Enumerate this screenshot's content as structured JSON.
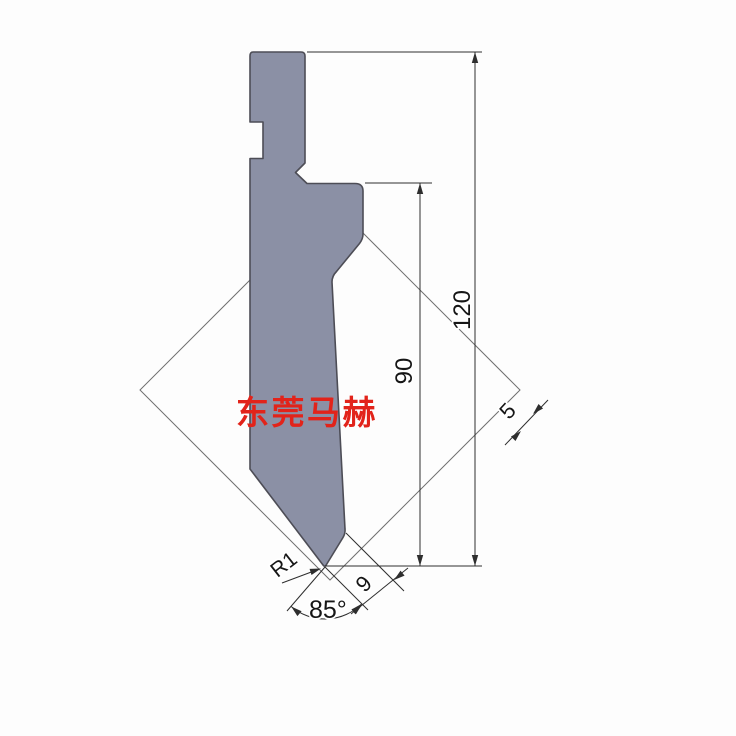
{
  "labels": {
    "overall_height": "120",
    "blade_height": "90",
    "grid_pitch": "5",
    "tip_width": "9",
    "tip_radius": "R1",
    "tip_angle": "85°"
  },
  "watermark": {
    "text": "东莞马赫",
    "color": "#e2231a"
  },
  "colors": {
    "punch_fill": "#8b90a5",
    "punch_outline": "#4d4d56",
    "grid_line": "#6f6f6f",
    "dimension_line": "#2e2e2e",
    "background": "#fdfdfd"
  }
}
